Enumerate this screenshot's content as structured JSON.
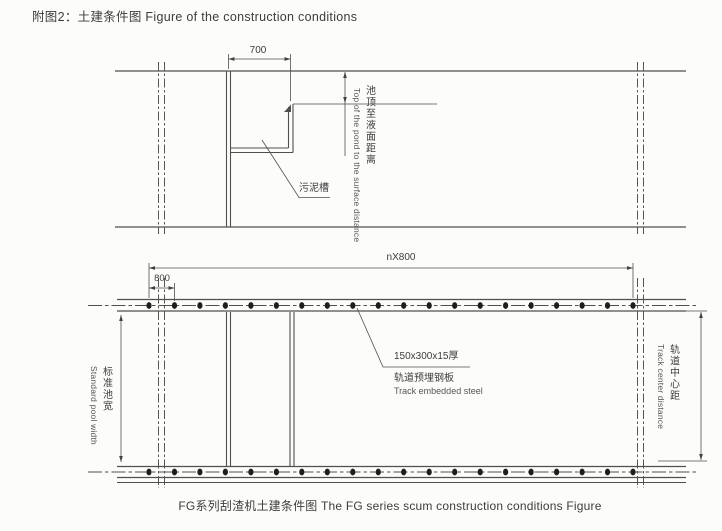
{
  "page": {
    "title": "附图2：土建条件图  Figure of the construction conditions",
    "caption": "FG系列刮渣机土建条件图  The FG series scum construction conditions Figure"
  },
  "section_view": {
    "width_dim": "700",
    "trough_label": "污泥槽",
    "depth_label_cn": "池顶至液面距离",
    "depth_label_en": "Top of the pond to the surface distance"
  },
  "plan_view": {
    "track_pitch_dim": "nX800",
    "plate_spacing_dim": "800",
    "plate_size_label": "150x300x15厚",
    "plate_label_cn": "轨道预埋钢板",
    "plate_label_en": "Track embedded steel",
    "pool_width_label_cn": "标准池宽",
    "pool_width_label_en": "Standard pool width",
    "track_center_label_cn": "轨道中心距",
    "track_center_label_en": "Track center distance"
  },
  "colors": {
    "line": "#4f4f4f",
    "text": "#3d3d3d",
    "background": "#fcfcfa",
    "plate_dot": "#1e1e1e"
  }
}
